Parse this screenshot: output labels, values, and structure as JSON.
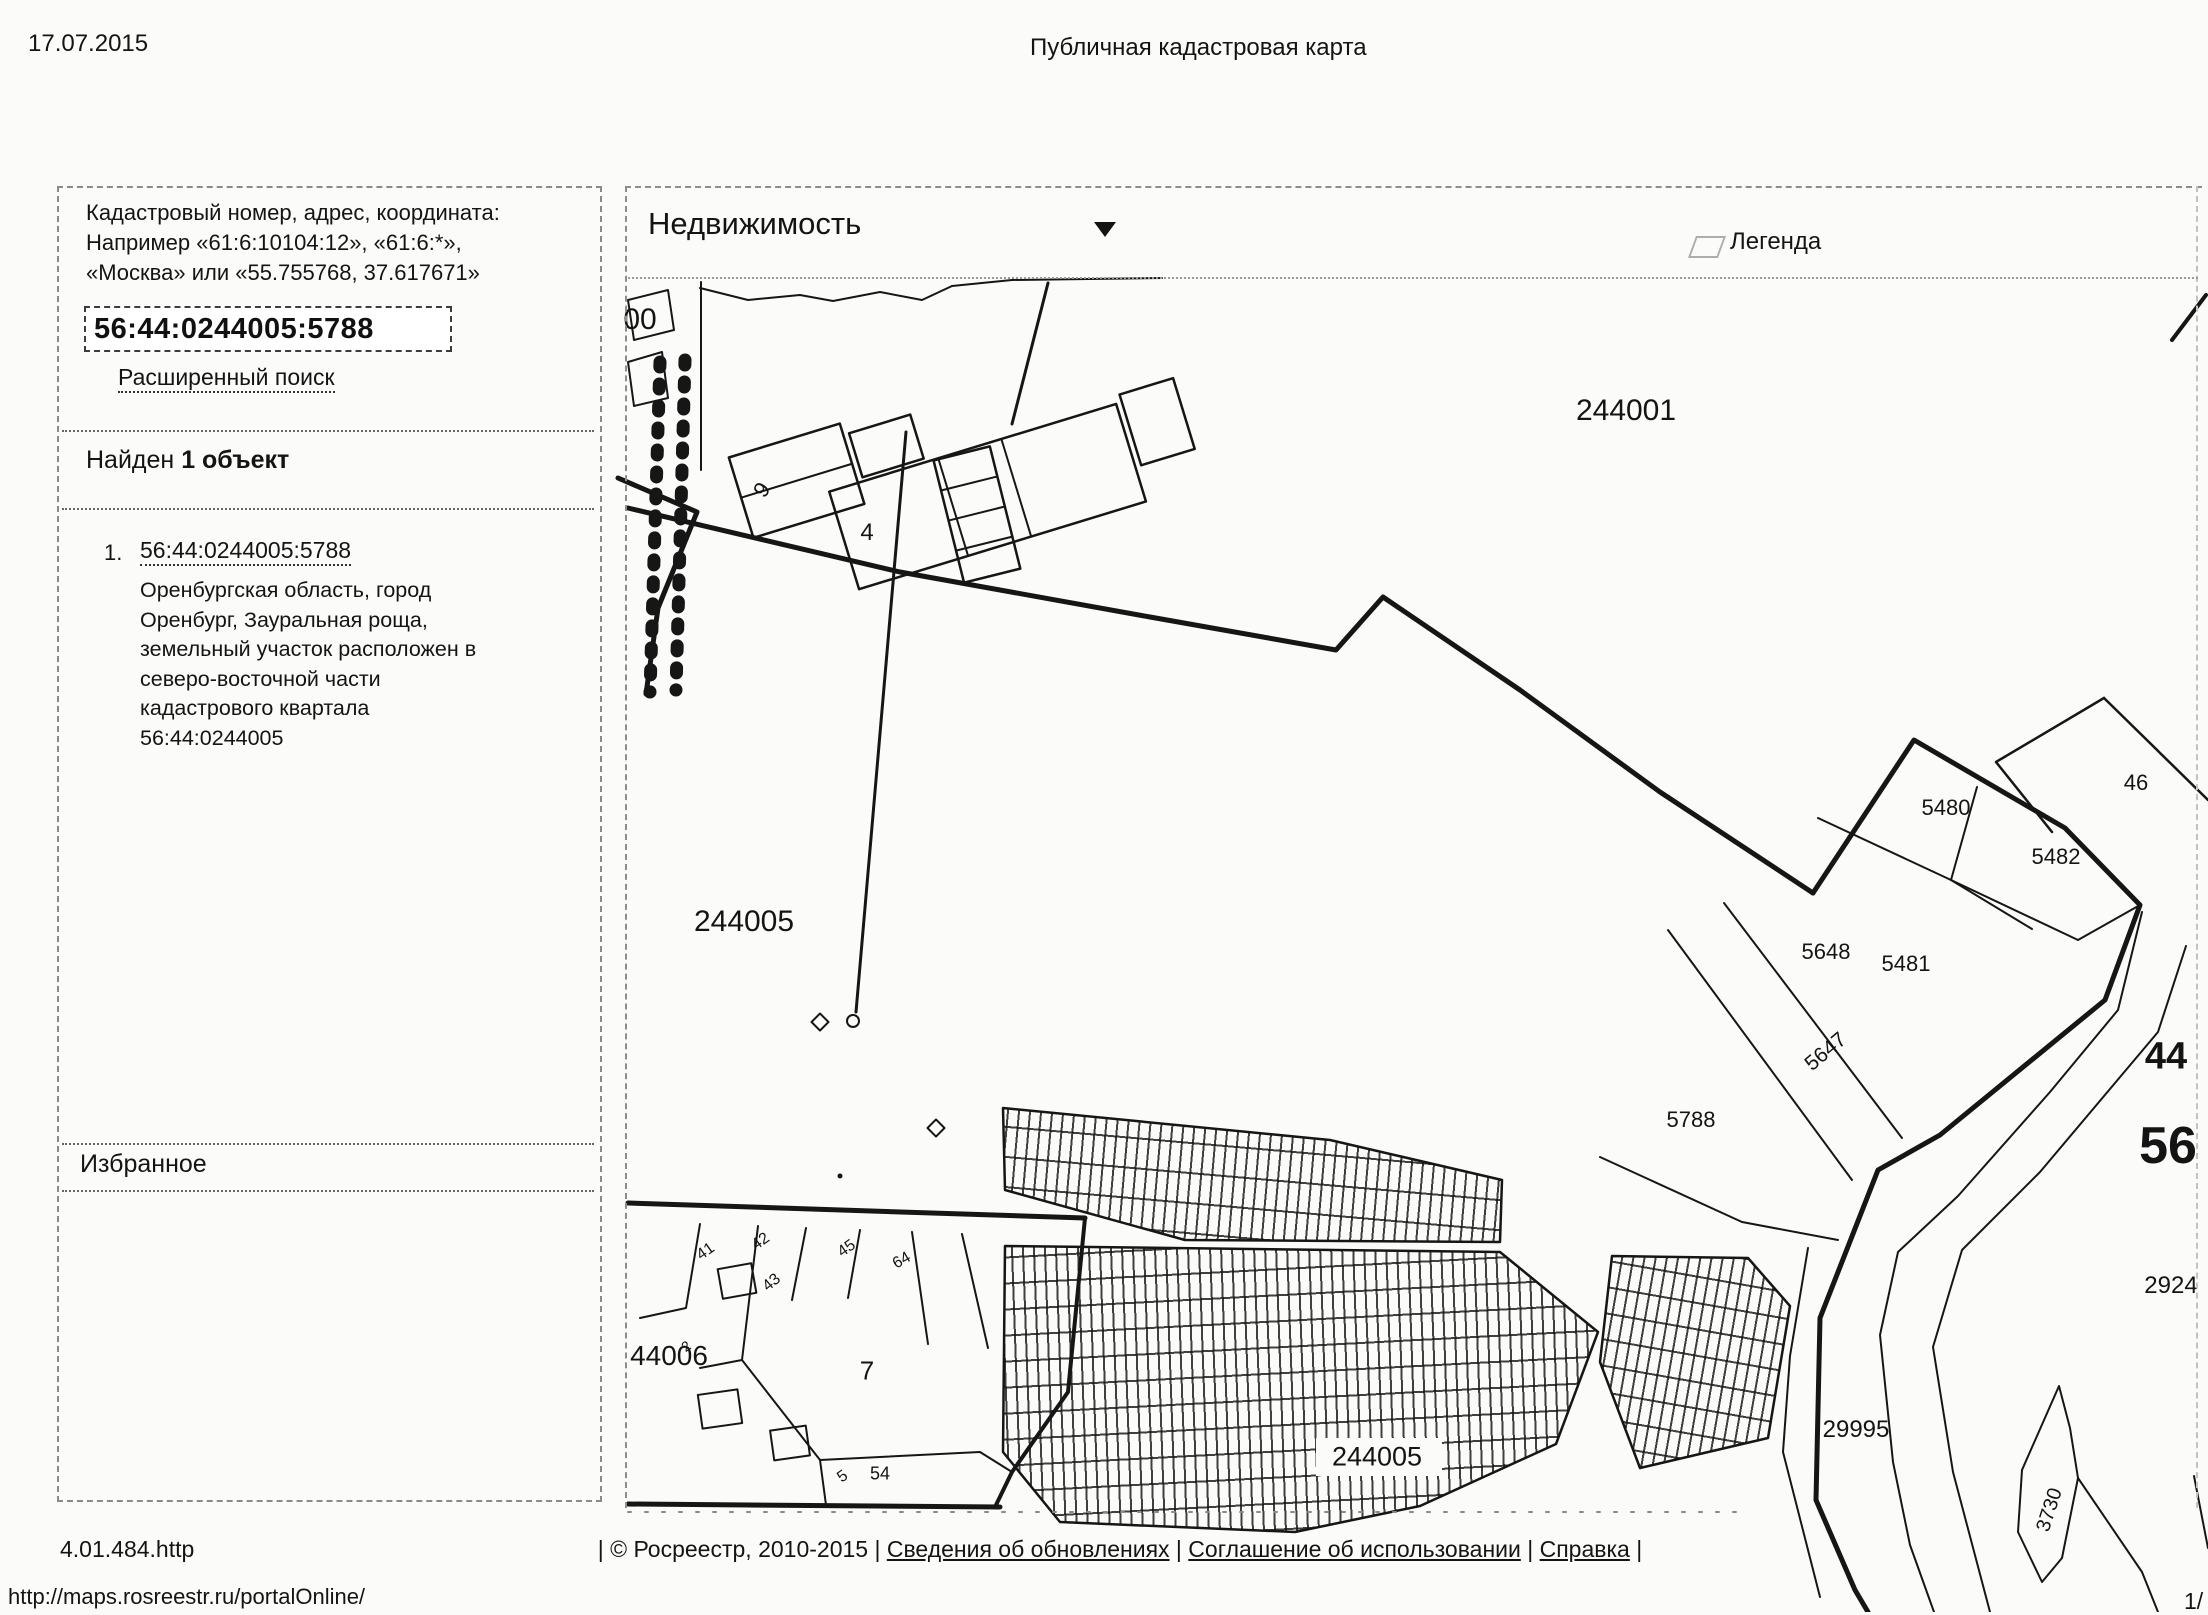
{
  "print": {
    "date": "17.07.2015",
    "title": "Публичная кадастровая карта",
    "version": "4.01.484.http",
    "url": "http://maps.rosreestr.ru/portalOnline/",
    "page_number": "1/"
  },
  "footer": {
    "separator": "|",
    "copyright": "© Росреестр, 2010-2015",
    "links": [
      "Сведения об обновлениях",
      "Соглашение об использовании",
      "Справка"
    ]
  },
  "sidebar": {
    "search_hint_lines": [
      "Кадастровый номер, адрес, координата:",
      "Например «61:6:10104:12», «61:6:*»,",
      "«Москва» или «55.755768, 37.617671»"
    ],
    "search_value": "56:44:0244005:5788",
    "advanced_search": "Расширенный поиск",
    "results_prefix": "Найден",
    "results_count": "1 объект",
    "result": {
      "index": "1.",
      "cadastral_number": "56:44:0244005:5788",
      "address": "Оренбургская область, город Оренбург, Зауральная роща, земельный участок расположен в северо-восточной части кадастрового квартала 56:44:0244005"
    },
    "favorites_title": "Избранное"
  },
  "map": {
    "layer_selector": "Недвижимость",
    "legend_label": "Легенда",
    "labels": [
      {
        "text": "00",
        "x": 640,
        "y": 320,
        "size": 30
      },
      {
        "text": "244001",
        "x": 1626,
        "y": 411,
        "size": 30
      },
      {
        "text": "9",
        "x": 762,
        "y": 490,
        "size": 22,
        "rot": -55
      },
      {
        "text": "4",
        "x": 867,
        "y": 533,
        "size": 24
      },
      {
        "text": "244005",
        "x": 744,
        "y": 922,
        "size": 30
      },
      {
        "text": "5480",
        "x": 1946,
        "y": 808,
        "size": 22
      },
      {
        "text": "46",
        "x": 2136,
        "y": 783,
        "size": 22
      },
      {
        "text": "5482",
        "x": 2056,
        "y": 857,
        "size": 22
      },
      {
        "text": "5648",
        "x": 1826,
        "y": 952,
        "size": 22
      },
      {
        "text": "5481",
        "x": 1906,
        "y": 964,
        "size": 22
      },
      {
        "text": "5647",
        "x": 1826,
        "y": 1052,
        "size": 21,
        "rot": -40
      },
      {
        "text": "5788",
        "x": 1691,
        "y": 1120,
        "size": 22
      },
      {
        "text": "44",
        "x": 2166,
        "y": 1057,
        "size": 38,
        "bold": true
      },
      {
        "text": "56",
        "x": 2168,
        "y": 1146,
        "size": 52,
        "bold": true
      },
      {
        "text": "2924",
        "x": 2171,
        "y": 1286,
        "size": 24
      },
      {
        "text": "29995",
        "x": 1856,
        "y": 1430,
        "size": 24
      },
      {
        "text": "3730",
        "x": 2050,
        "y": 1510,
        "size": 20,
        "rot": -72
      },
      {
        "text": "44006",
        "x": 669,
        "y": 1356,
        "size": 28
      },
      {
        "text": "7",
        "x": 867,
        "y": 1371,
        "size": 26
      },
      {
        "text": "244005",
        "x": 1377,
        "y": 1457,
        "size": 27
      },
      {
        "text": "41",
        "x": 706,
        "y": 1252,
        "size": 16,
        "rot": -35
      },
      {
        "text": "42",
        "x": 761,
        "y": 1242,
        "size": 16,
        "rot": -35
      },
      {
        "text": "43",
        "x": 772,
        "y": 1283,
        "size": 16,
        "rot": -40
      },
      {
        "text": "45",
        "x": 847,
        "y": 1249,
        "size": 16,
        "rot": -35
      },
      {
        "text": "64",
        "x": 902,
        "y": 1261,
        "size": 16,
        "rot": -30
      },
      {
        "text": "2",
        "x": 686,
        "y": 1346,
        "size": 14,
        "rot": -35
      },
      {
        "text": "5",
        "x": 843,
        "y": 1477,
        "size": 16,
        "rot": -35
      },
      {
        "text": "54",
        "x": 880,
        "y": 1474,
        "size": 18
      }
    ],
    "ink_color": "#161616"
  }
}
